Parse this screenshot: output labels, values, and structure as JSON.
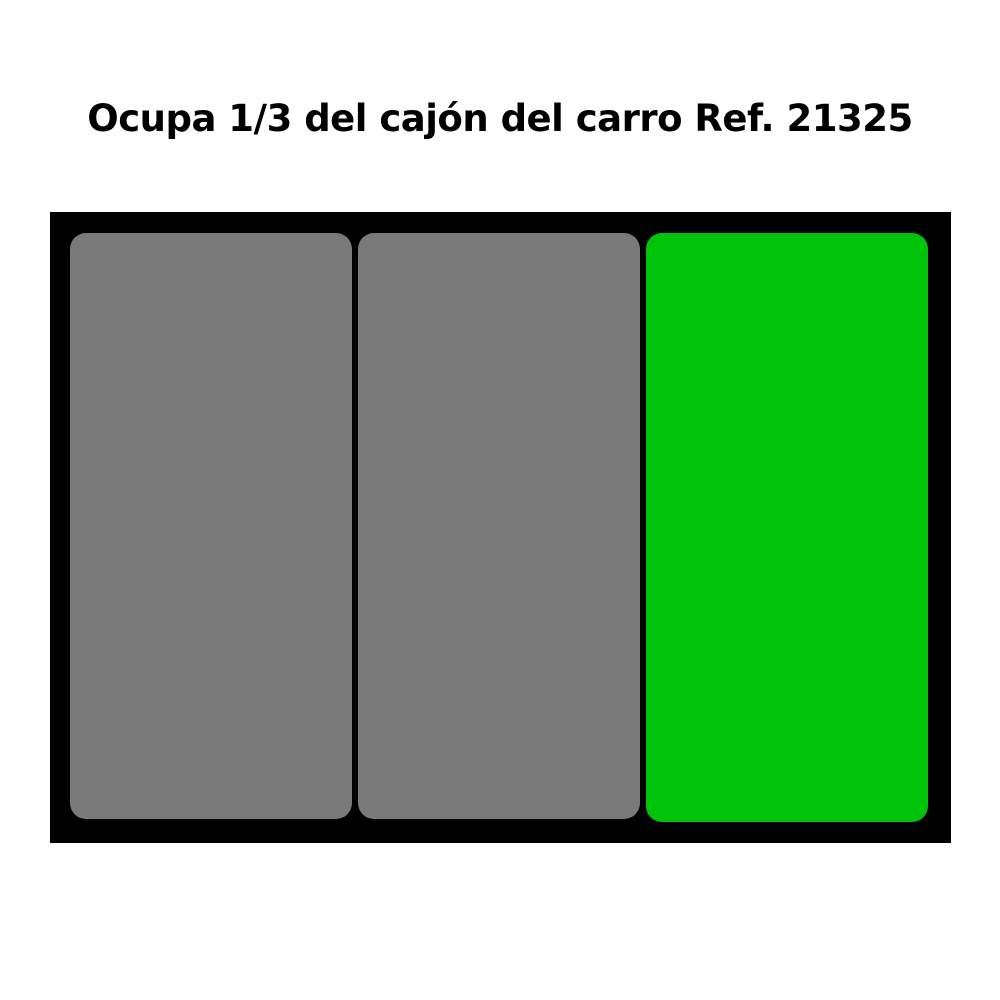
{
  "page": {
    "title": "Ocupa 1/3 del cajón del carro Ref. 21325"
  },
  "colors": {
    "background": "#ffffff",
    "title_text": "#000000",
    "drawer_frame": "#000000",
    "slot_gray": "#7a7a7a",
    "slot_green": "#00c40a"
  },
  "drawer": {
    "slots": [
      {
        "id": "slot-1",
        "state": "occupied-other",
        "color": "#7a7a7a"
      },
      {
        "id": "slot-2",
        "state": "occupied-other",
        "color": "#7a7a7a"
      },
      {
        "id": "slot-3",
        "state": "highlighted-product",
        "color": "#00c40a"
      }
    ]
  }
}
